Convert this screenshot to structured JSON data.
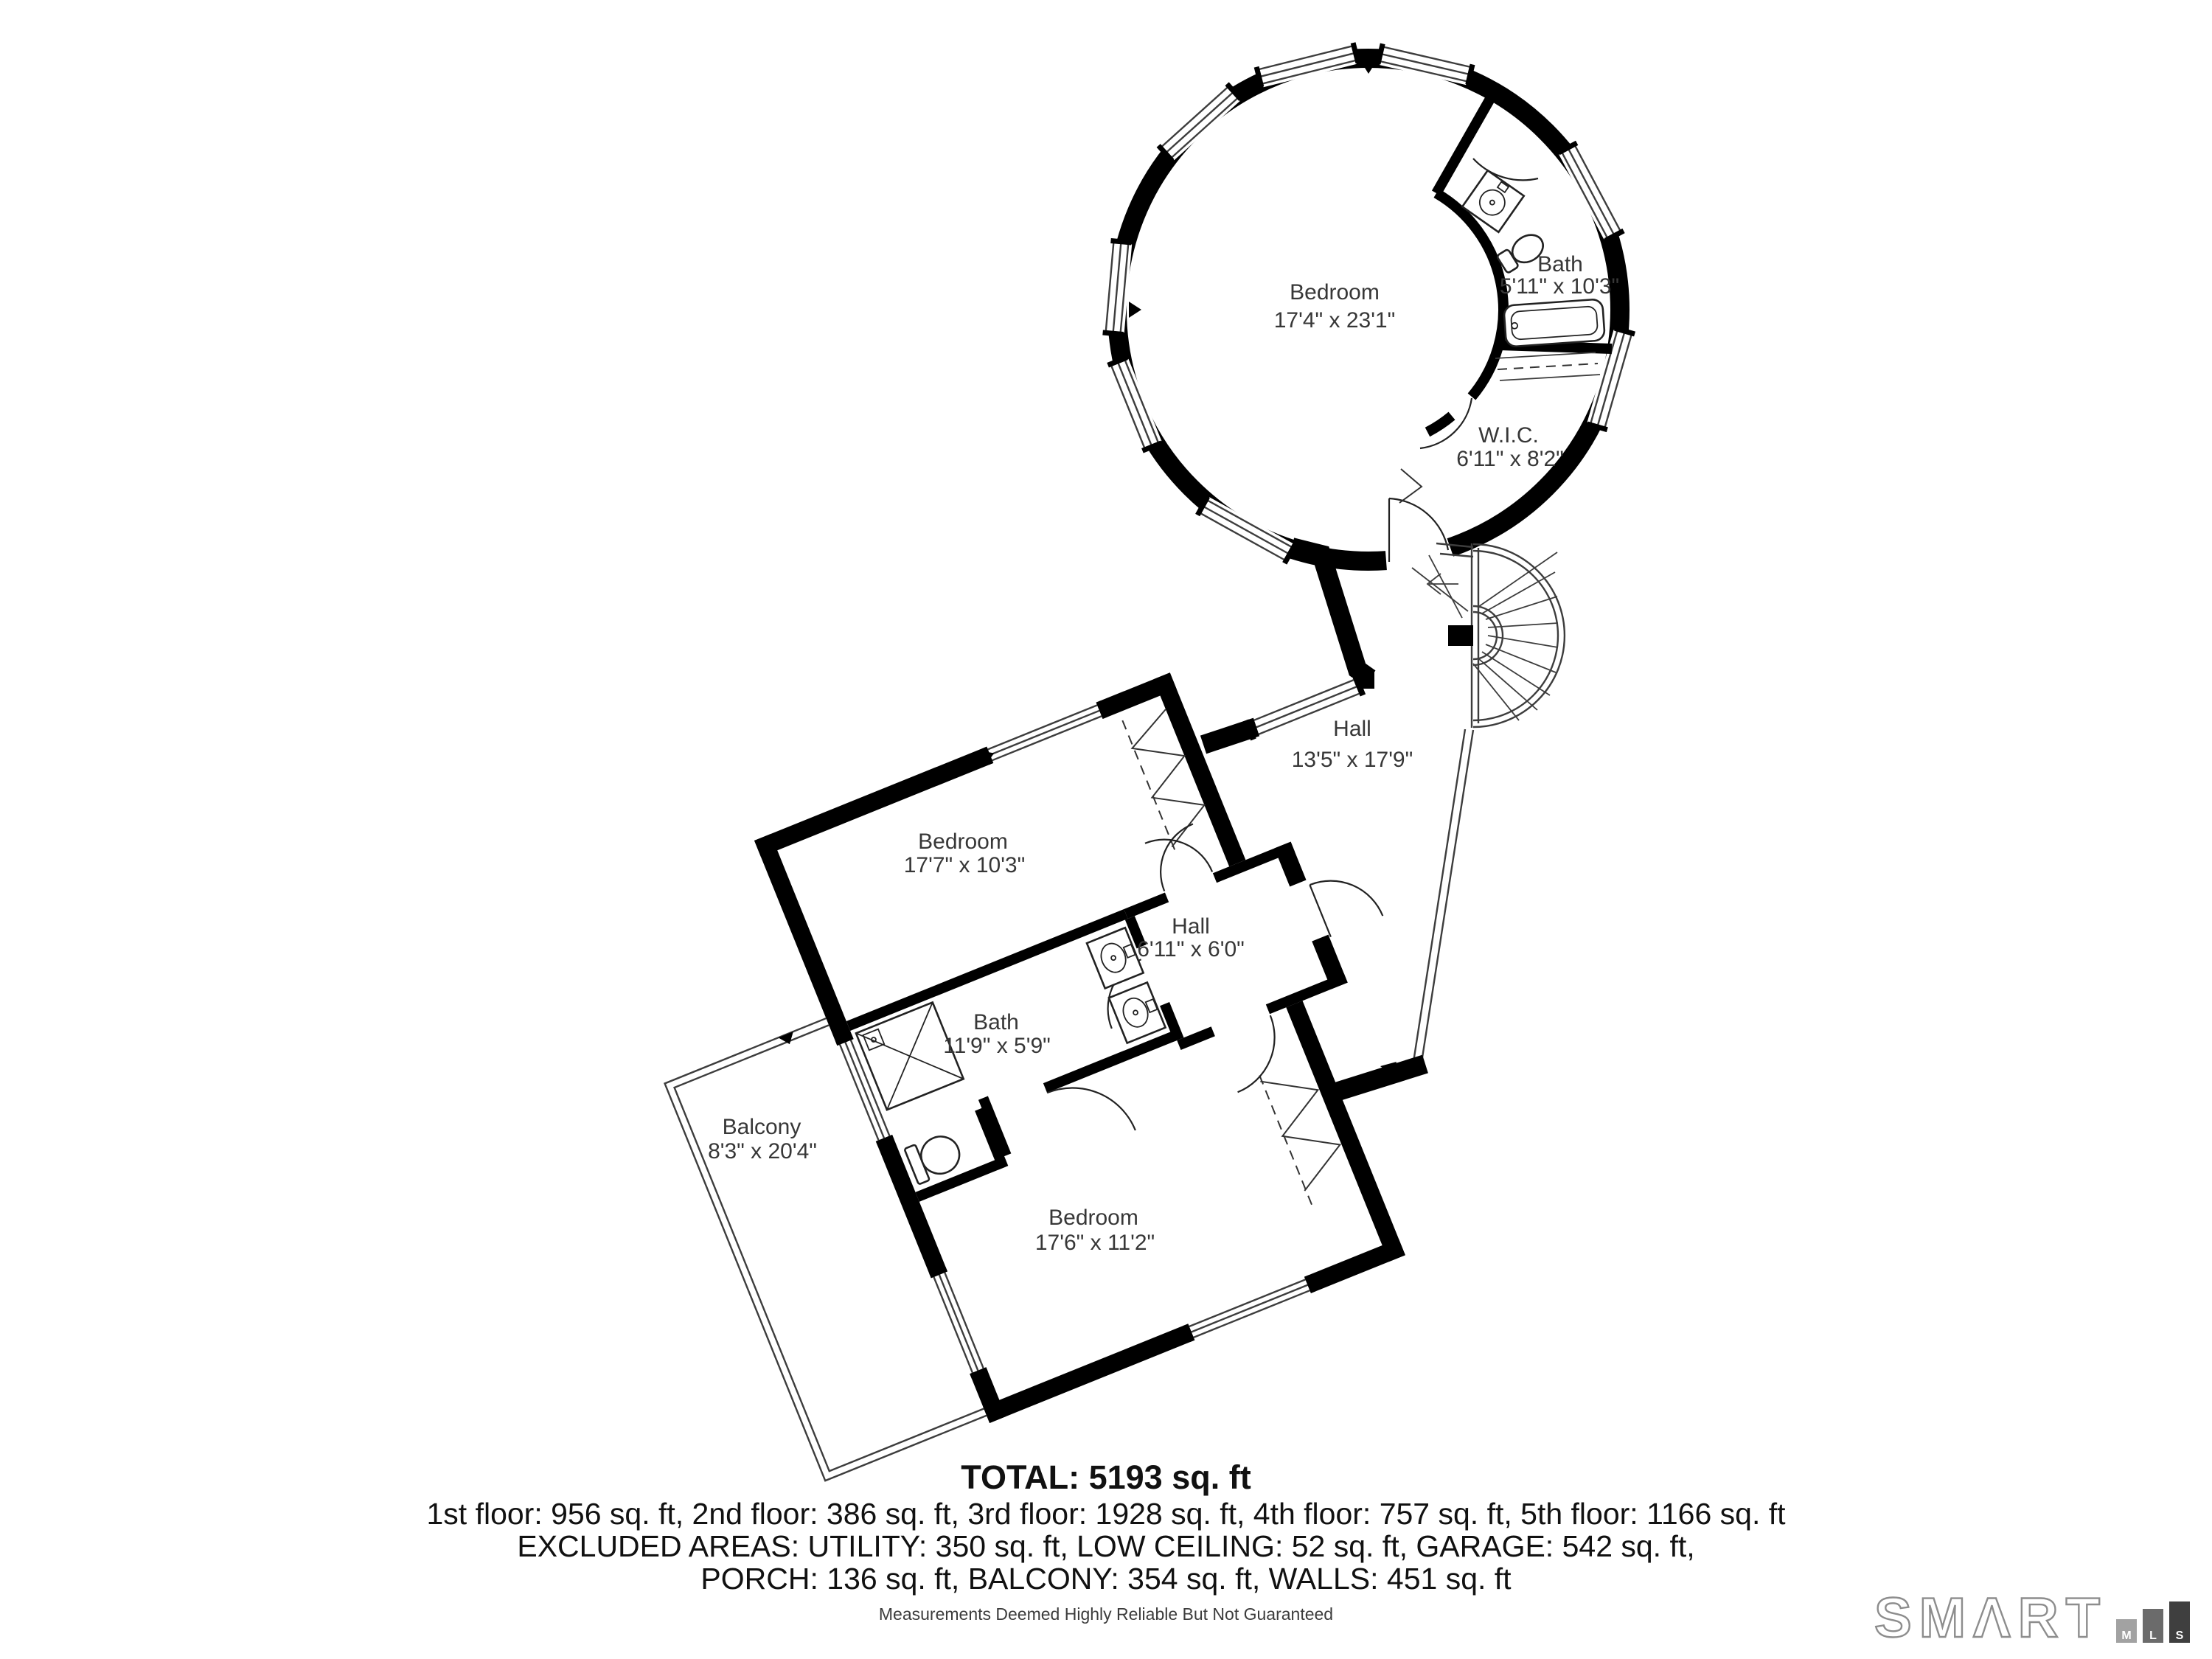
{
  "rooms": {
    "tower_bedroom": {
      "name": "Bedroom",
      "dims": "17'4\" x 23'1\""
    },
    "tower_bath": {
      "name": "Bath",
      "dims": "5'11\" x 10'3\""
    },
    "wic": {
      "name": "W.I.C.",
      "dims": "6'11\" x 8'2\""
    },
    "hall": {
      "name": "Hall",
      "dims": "13'5\" x 17'9\""
    },
    "bedroom_mid": {
      "name": "Bedroom",
      "dims": "17'7\" x 10'3\""
    },
    "hall_small": {
      "name": "Hall",
      "dims": "6'11\" x 6'0\""
    },
    "bath_mid": {
      "name": "Bath",
      "dims": "11'9\" x 5'9\""
    },
    "balcony": {
      "name": "Balcony",
      "dims": "8'3\" x 20'4\""
    },
    "bedroom_lower": {
      "name": "Bedroom",
      "dims": "17'6\" x 11'2\""
    }
  },
  "summary": {
    "total": "TOTAL: 5193 sq. ft",
    "floors": "1st floor: 956 sq. ft, 2nd floor: 386 sq. ft, 3rd floor: 1928 sq. ft, 4th floor: 757 sq. ft, 5th floor: 1166 sq. ft",
    "excluded_1": "EXCLUDED AREAS: UTILITY: 350 sq. ft, LOW CEILING: 52 sq. ft, GARAGE: 542 sq. ft,",
    "excluded_2": "PORCH: 136 sq. ft, BALCONY: 354 sq. ft, WALLS: 451 sq. ft",
    "disclaimer": "Measurements Deemed Highly Reliable But Not Guaranteed"
  },
  "logo": {
    "word": "SMΛRT",
    "badges": {
      "m": "M",
      "l": "L",
      "s": "S"
    }
  },
  "colors": {
    "wall": "#000000",
    "label_text": "#373737",
    "logo_outline": "#8d8d8d",
    "bar_m": "#a2a2a2",
    "bar_l": "#6b6b6b",
    "bar_s": "#3f3f3f"
  }
}
